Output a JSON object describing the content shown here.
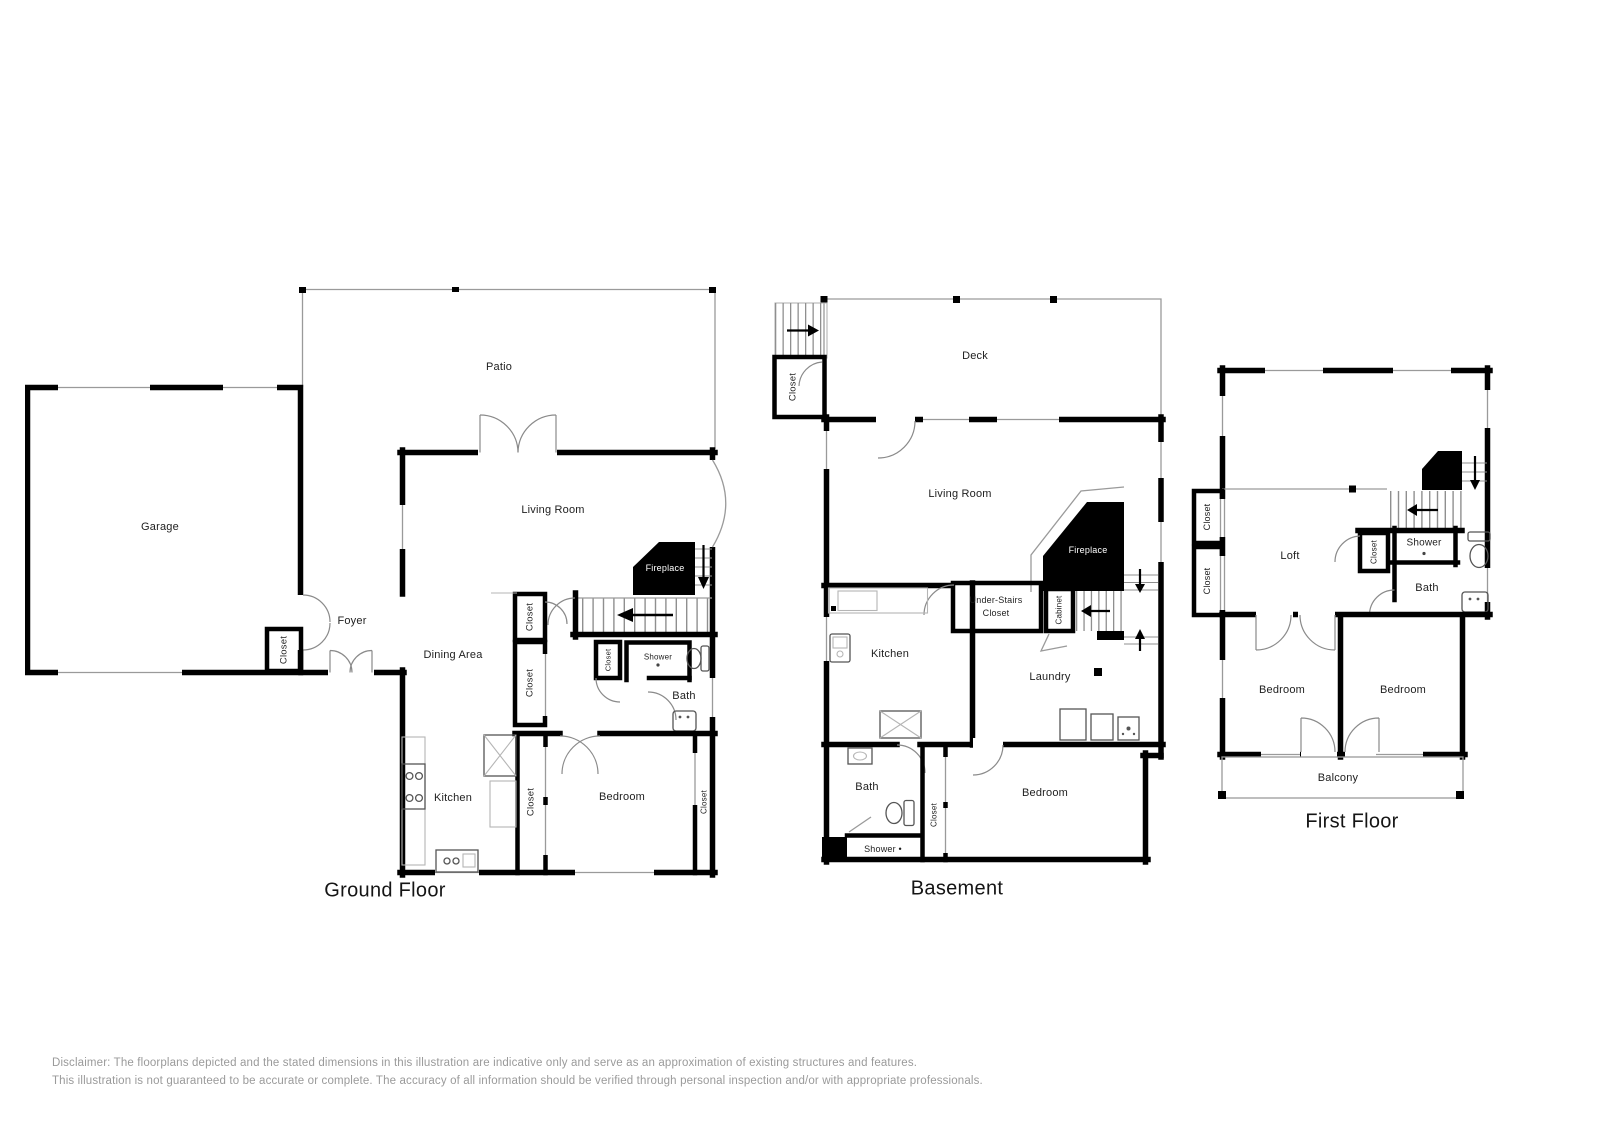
{
  "page": {
    "background": "#ffffff"
  },
  "ground_floor": {
    "title": "Ground Floor",
    "labels": {
      "patio": "Patio",
      "garage": "Garage",
      "living_room": "Living Room",
      "fireplace": "Fireplace",
      "foyer": "Foyer",
      "closet_foyer": "Closet",
      "dining_area": "Dining Area",
      "closet_hall_upper": "Closet",
      "closet_hall_lower": "Closet",
      "closet_bath": "Closet",
      "shower": "Shower",
      "bath": "Bath",
      "kitchen": "Kitchen",
      "closet_kitchen": "Closet",
      "bedroom": "Bedroom",
      "closet_bedroom": "Closet"
    }
  },
  "basement": {
    "title": "Basement",
    "labels": {
      "deck": "Deck",
      "closet_entry": "Closet",
      "living_room": "Living Room",
      "fireplace": "Fireplace",
      "under_stairs_closet_line1": "Under-Stairs",
      "under_stairs_closet_line2": "Closet",
      "cabinet": "Cabinet",
      "kitchen": "Kitchen",
      "laundry": "Laundry",
      "bath": "Bath",
      "shower": "Shower •",
      "closet_hall": "Closet",
      "bedroom": "Bedroom"
    }
  },
  "first_floor": {
    "title": "First Floor",
    "labels": {
      "loft": "Loft",
      "closet_upper": "Closet",
      "closet_lower": "Closet",
      "closet_stairs": "Closet",
      "shower": "Shower",
      "bath": "Bath",
      "bedroom_left": "Bedroom",
      "bedroom_right": "Bedroom",
      "balcony": "Balcony"
    }
  },
  "disclaimer": {
    "line1": "Disclaimer: The floorplans depicted and the stated dimensions in this illustration are indicative only and serve as an approximation of existing structures and features.",
    "line2": "This illustration is not guaranteed to be accurate or complete. The accuracy of all information should be verified through personal inspection and/or with appropriate professionals."
  }
}
